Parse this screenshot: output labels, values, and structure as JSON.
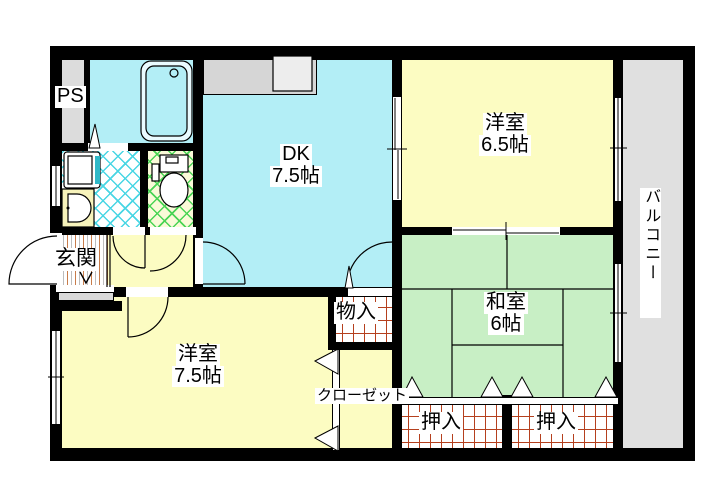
{
  "rooms": {
    "ps": {
      "label": "PS"
    },
    "entrance": {
      "label": "玄関"
    },
    "dining_kitchen": {
      "name": "DK",
      "size": "7.5帖"
    },
    "western_room_65": {
      "name": "洋室",
      "size": "6.5帖"
    },
    "western_room_75": {
      "name": "洋室",
      "size": "7.5帖"
    },
    "japanese_room": {
      "name": "和室",
      "size": "6帖"
    },
    "balcony": {
      "label": "バルコニー"
    },
    "storage": {
      "label": "物入"
    },
    "closet": {
      "label": "クローゼット"
    },
    "oshiire_left": {
      "label": "押入"
    },
    "oshiire_right": {
      "label": "押入"
    }
  },
  "colors": {
    "wall": "#000000",
    "room_cyan": "#b3eef6",
    "room_yellow": "#fcfcc2",
    "room_green": "#c8efc5",
    "balcony_gray": "#e0e0e0",
    "ps_gray": "#dcdcdc",
    "counter_gray": "#d6d6d6",
    "oshiire_grid_line": "#b5401e",
    "washroom_lattice": "#49d6e4",
    "toilet_lattice": "#4ad455",
    "toilet_floor": "#fafad8"
  }
}
